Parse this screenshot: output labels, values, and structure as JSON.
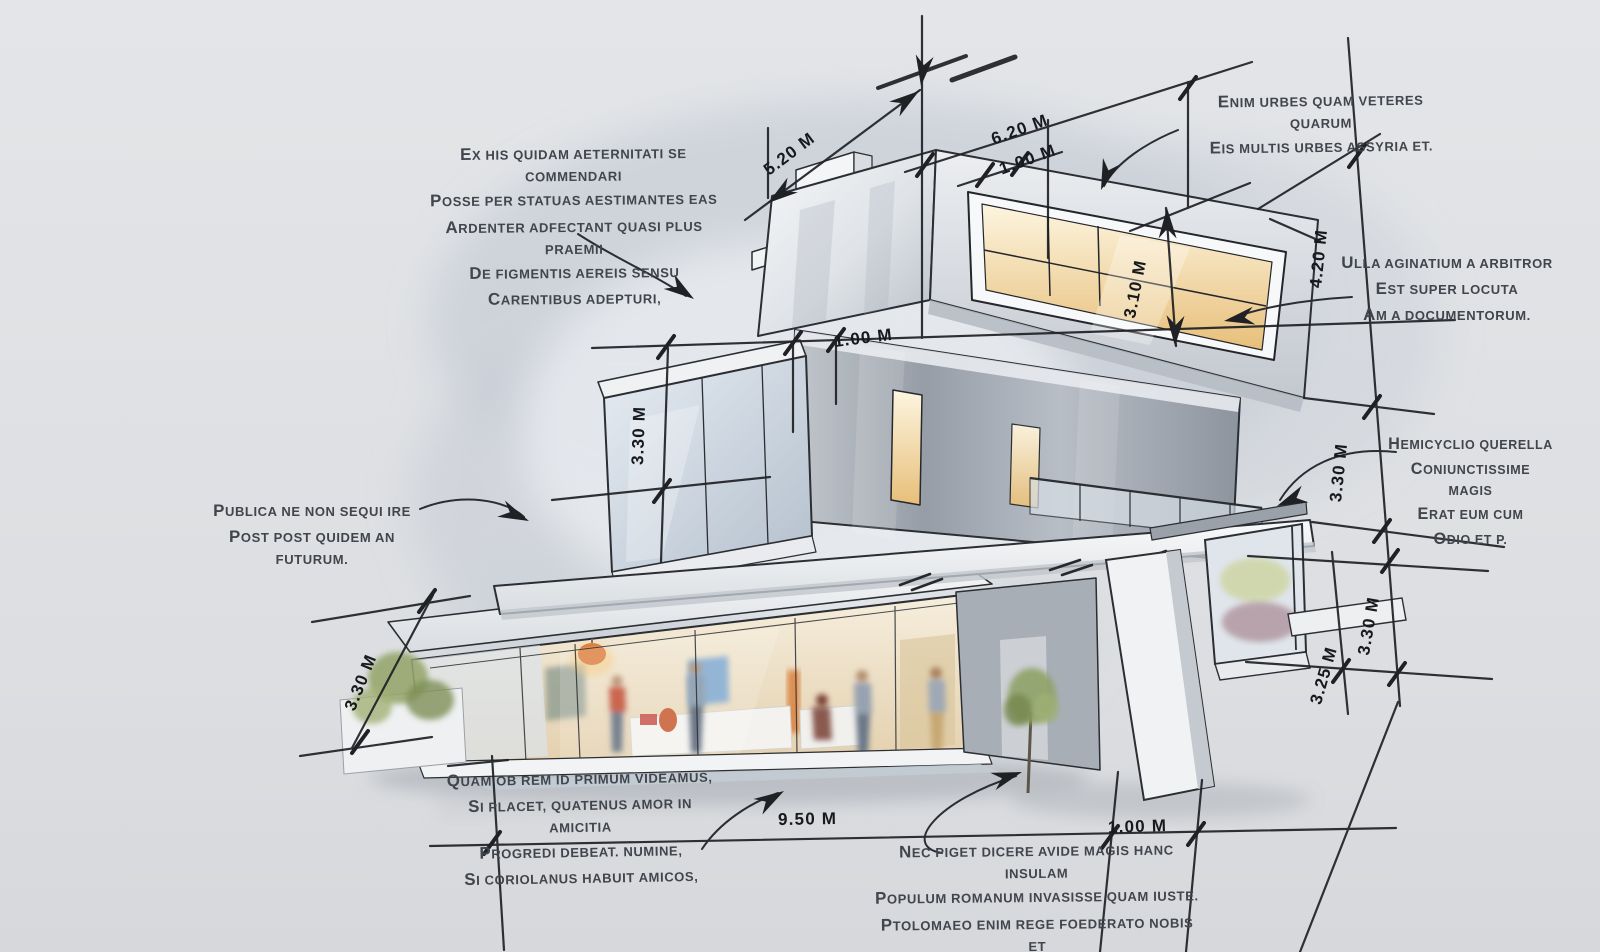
{
  "scene": {
    "type": "architectural-concept-sketch",
    "subject": "Modern three-storey stacked-box house with hand-drawn dimension lines and handwritten Latin annotations",
    "background_color": "#e0e2e6",
    "floor_color": "#d4d6d9",
    "ink_color": "#1f2125",
    "note_color": "#41454c",
    "warm_light_color": "#e9c47e",
    "accent_orange": "#dd8140"
  },
  "notes": {
    "top_left": {
      "lines": [
        "Ex his quidam aeternitati se commendari",
        "posse per statuas aestimantes eas",
        "ardenter adfectant quasi plus praemii",
        "de figmentis aereis sensu",
        "carentibus adepturi,"
      ]
    },
    "top_right": {
      "lines": [
        "Enim urbes quam veteres quarum",
        "eis multis urbes Assyria et."
      ]
    },
    "right_upper": {
      "lines": [
        "Ulla aginatium a arbitror",
        "est super locuta",
        "am a documentorum."
      ]
    },
    "right_middle": {
      "lines": [
        "Hemicyclio querella",
        "coniunctissime magis",
        "erat eum cum",
        "odio et P."
      ]
    },
    "left_middle": {
      "lines": [
        "Publica ne non sequi ire",
        "post post quidem an futurum."
      ]
    },
    "bottom_center": {
      "lines": [
        "Quam ob rem id primum videamus,",
        "si placet, quatenus amor in amicitia",
        "progredi debeat. Numine,",
        "si Coriolanus habuit amicos,"
      ]
    },
    "bottom_right": {
      "lines": [
        "Nec piget dicere avide magis hanc insulam",
        "populum Romanum invasisse quam iuste.",
        "Ptolomaeo enim rege foederato nobis et",
        "socio ob aerarii nostri angustias iusso"
      ]
    }
  },
  "dimensions": {
    "top_width_a": {
      "label": "5.20 m"
    },
    "top_width_b": {
      "label": "6.20 m"
    },
    "top_offset": {
      "label": "1.00 m"
    },
    "upper_window_height": {
      "label": "3.10 m"
    },
    "right_total_height": {
      "label": "4.20 m"
    },
    "mid_offset": {
      "label": "1.00 m"
    },
    "mid_floor_height": {
      "label": "3.30 m"
    },
    "right_upper_height": {
      "label": "3.30 m"
    },
    "right_lower_height": {
      "label": "3.30 m"
    },
    "right_lower_offset": {
      "label": "3.25 m"
    },
    "left_floor_height": {
      "label": "3.30 m"
    },
    "base_width": {
      "label": "9.50 m"
    },
    "base_offset": {
      "label": "1.00 m"
    }
  }
}
